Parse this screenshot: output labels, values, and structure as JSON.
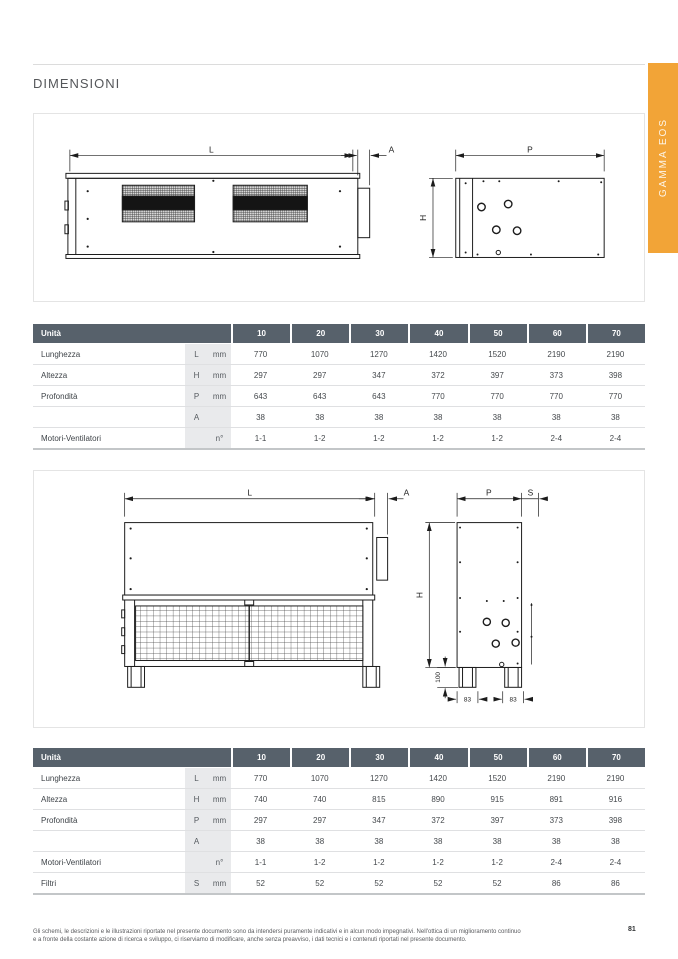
{
  "page": {
    "title": "DIMENSIONI",
    "side_tab": "GAMMA EOS",
    "page_number": "81",
    "footer_line1": "Gli schemi, le descrizioni e le illustrazioni riportate nel presente documento sono da intendersi puramente indicativi e in alcun modo impegnativi. Nell'ottica di un miglioramento continuo",
    "footer_line2": "e a fronte della costante azione di ricerca e sviluppo, ci riserviamo di modificare, anche senza preavviso, i dati tecnici e i contenuti riportati nel presente documento."
  },
  "colors": {
    "accent_orange": "#F2A437",
    "table_header_gray": "#57616B",
    "table_subcolumn_bg": "#E9EAEC",
    "row_border": "#DFE0E2"
  },
  "diagram1": {
    "dim_length": "L",
    "dim_flange": "A",
    "dim_depth": "P",
    "dim_height": "H"
  },
  "diagram2": {
    "dim_length": "L",
    "dim_flange": "A",
    "dim_depth": "P",
    "dim_filter": "S",
    "dim_height": "H",
    "dim_foot_height": "100",
    "dim_foot_width_left": "83",
    "dim_foot_width_right": "83"
  },
  "table1": {
    "header_label": "Unità",
    "columns": [
      "10",
      "20",
      "30",
      "40",
      "50",
      "60",
      "70"
    ],
    "rows": [
      {
        "label": "Lunghezza",
        "sym": "L",
        "unit": "mm",
        "values": [
          "770",
          "1070",
          "1270",
          "1420",
          "1520",
          "2190",
          "2190"
        ]
      },
      {
        "label": "Altezza",
        "sym": "H",
        "unit": "mm",
        "values": [
          "297",
          "297",
          "347",
          "372",
          "397",
          "373",
          "398"
        ]
      },
      {
        "label": "Profondità",
        "sym": "P",
        "unit": "mm",
        "values": [
          "643",
          "643",
          "643",
          "770",
          "770",
          "770",
          "770"
        ]
      },
      {
        "label": "",
        "sym": "A",
        "unit": "",
        "values": [
          "38",
          "38",
          "38",
          "38",
          "38",
          "38",
          "38"
        ]
      },
      {
        "label": "Motori-Ventilatori",
        "sym": "",
        "unit": "n°",
        "values": [
          "1-1",
          "1-2",
          "1-2",
          "1-2",
          "1-2",
          "2-4",
          "2-4"
        ]
      }
    ]
  },
  "table2": {
    "header_label": "Unità",
    "columns": [
      "10",
      "20",
      "30",
      "40",
      "50",
      "60",
      "70"
    ],
    "rows": [
      {
        "label": "Lunghezza",
        "sym": "L",
        "unit": "mm",
        "values": [
          "770",
          "1070",
          "1270",
          "1420",
          "1520",
          "2190",
          "2190"
        ]
      },
      {
        "label": "Altezza",
        "sym": "H",
        "unit": "mm",
        "values": [
          "740",
          "740",
          "815",
          "890",
          "915",
          "891",
          "916"
        ]
      },
      {
        "label": "Profondità",
        "sym": "P",
        "unit": "mm",
        "values": [
          "297",
          "297",
          "347",
          "372",
          "397",
          "373",
          "398"
        ]
      },
      {
        "label": "",
        "sym": "A",
        "unit": "",
        "values": [
          "38",
          "38",
          "38",
          "38",
          "38",
          "38",
          "38"
        ]
      },
      {
        "label": "Motori-Ventilatori",
        "sym": "",
        "unit": "n°",
        "values": [
          "1-1",
          "1-2",
          "1-2",
          "1-2",
          "1-2",
          "2-4",
          "2-4"
        ]
      },
      {
        "label": "Filtri",
        "sym": "S",
        "unit": "mm",
        "values": [
          "52",
          "52",
          "52",
          "52",
          "52",
          "86",
          "86"
        ]
      }
    ]
  }
}
